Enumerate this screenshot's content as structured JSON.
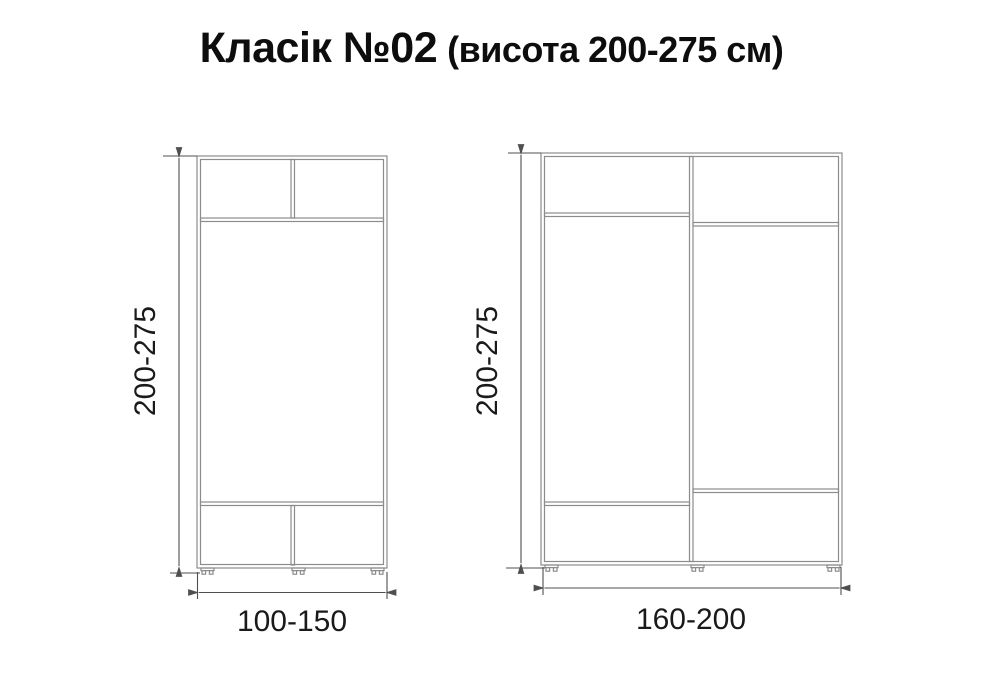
{
  "title": {
    "product_name": "Класік №02",
    "height_note": "(висота 200-275 см)"
  },
  "diagram": {
    "colors": {
      "cabinet_line": "#8c8c8c",
      "dimension_line": "#4f4f4f",
      "text": "#1a1a1a"
    },
    "left_wardrobe": {
      "height_label": "200-275",
      "width_label": "100-150"
    },
    "right_wardrobe": {
      "height_label": "200-275",
      "width_label": "160-200"
    }
  }
}
